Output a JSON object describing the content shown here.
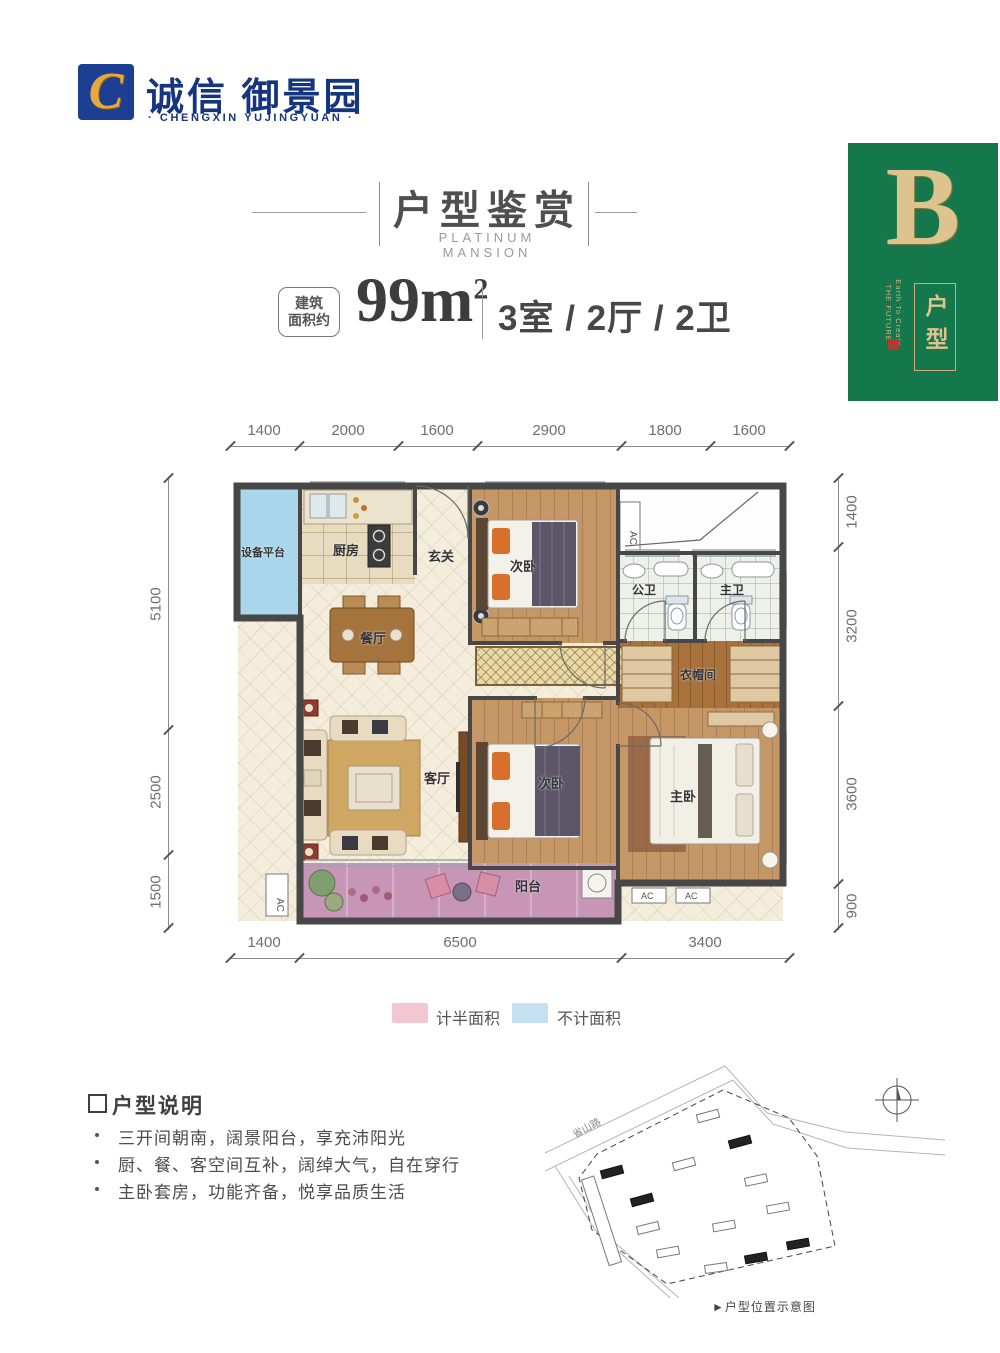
{
  "brand": {
    "logo_letter": "C",
    "name_cn": "诚信 御景园",
    "name_en": "· CHENGXIN YUJINGYUAN ·"
  },
  "header": {
    "title_cn": "户型鉴赏",
    "title_en": "PLATINUM MANSION"
  },
  "area": {
    "tag_line1": "建筑",
    "tag_line2": "面积约",
    "size": "99m",
    "size_sup": "2",
    "rooms": "3室 / 2厅 / 2卫"
  },
  "badge": {
    "letter": "B",
    "side_line1": "Earth To Create",
    "side_line2": "THE FUTURE",
    "seal": "印",
    "tag": "户型",
    "green": "#15784d",
    "gold": "#ddc48e"
  },
  "plan": {
    "dims_top": [
      "1400",
      "2000",
      "1600",
      "2900",
      "1800",
      "1600"
    ],
    "dims_left": [
      "5100",
      "2500",
      "1500"
    ],
    "dims_right": [
      "1400",
      "3200",
      "3600",
      "900"
    ],
    "dims_bottom": [
      "1400",
      "6500",
      "3400"
    ],
    "rooms": {
      "equipment": "设备平台",
      "kitchen": "厨房",
      "foyer": "玄关",
      "bedroom_top": "次卧",
      "bath_public": "公卫",
      "bath_master": "主卫",
      "dining": "餐厅",
      "cloakroom": "衣帽间",
      "living": "客厅",
      "bedroom_mid": "次卧",
      "master": "主卧",
      "balcony": "阳台",
      "ac": "AC"
    }
  },
  "legend": {
    "half_label": "计半面积",
    "half_color": "#f3c7d2",
    "excluded_label": "不计面积",
    "excluded_color": "#c5e0f0"
  },
  "notes": {
    "title": "户型说明",
    "items": [
      "三开间朝南，阔景阳台，享充沛阳光",
      "厨、餐、客空间互补，阔绰大气，自在穿行",
      "主卧套房，功能齐备，悦享品质生活"
    ]
  },
  "sitemap": {
    "road_label": "省山路",
    "caption": "►户型位置示意图"
  }
}
